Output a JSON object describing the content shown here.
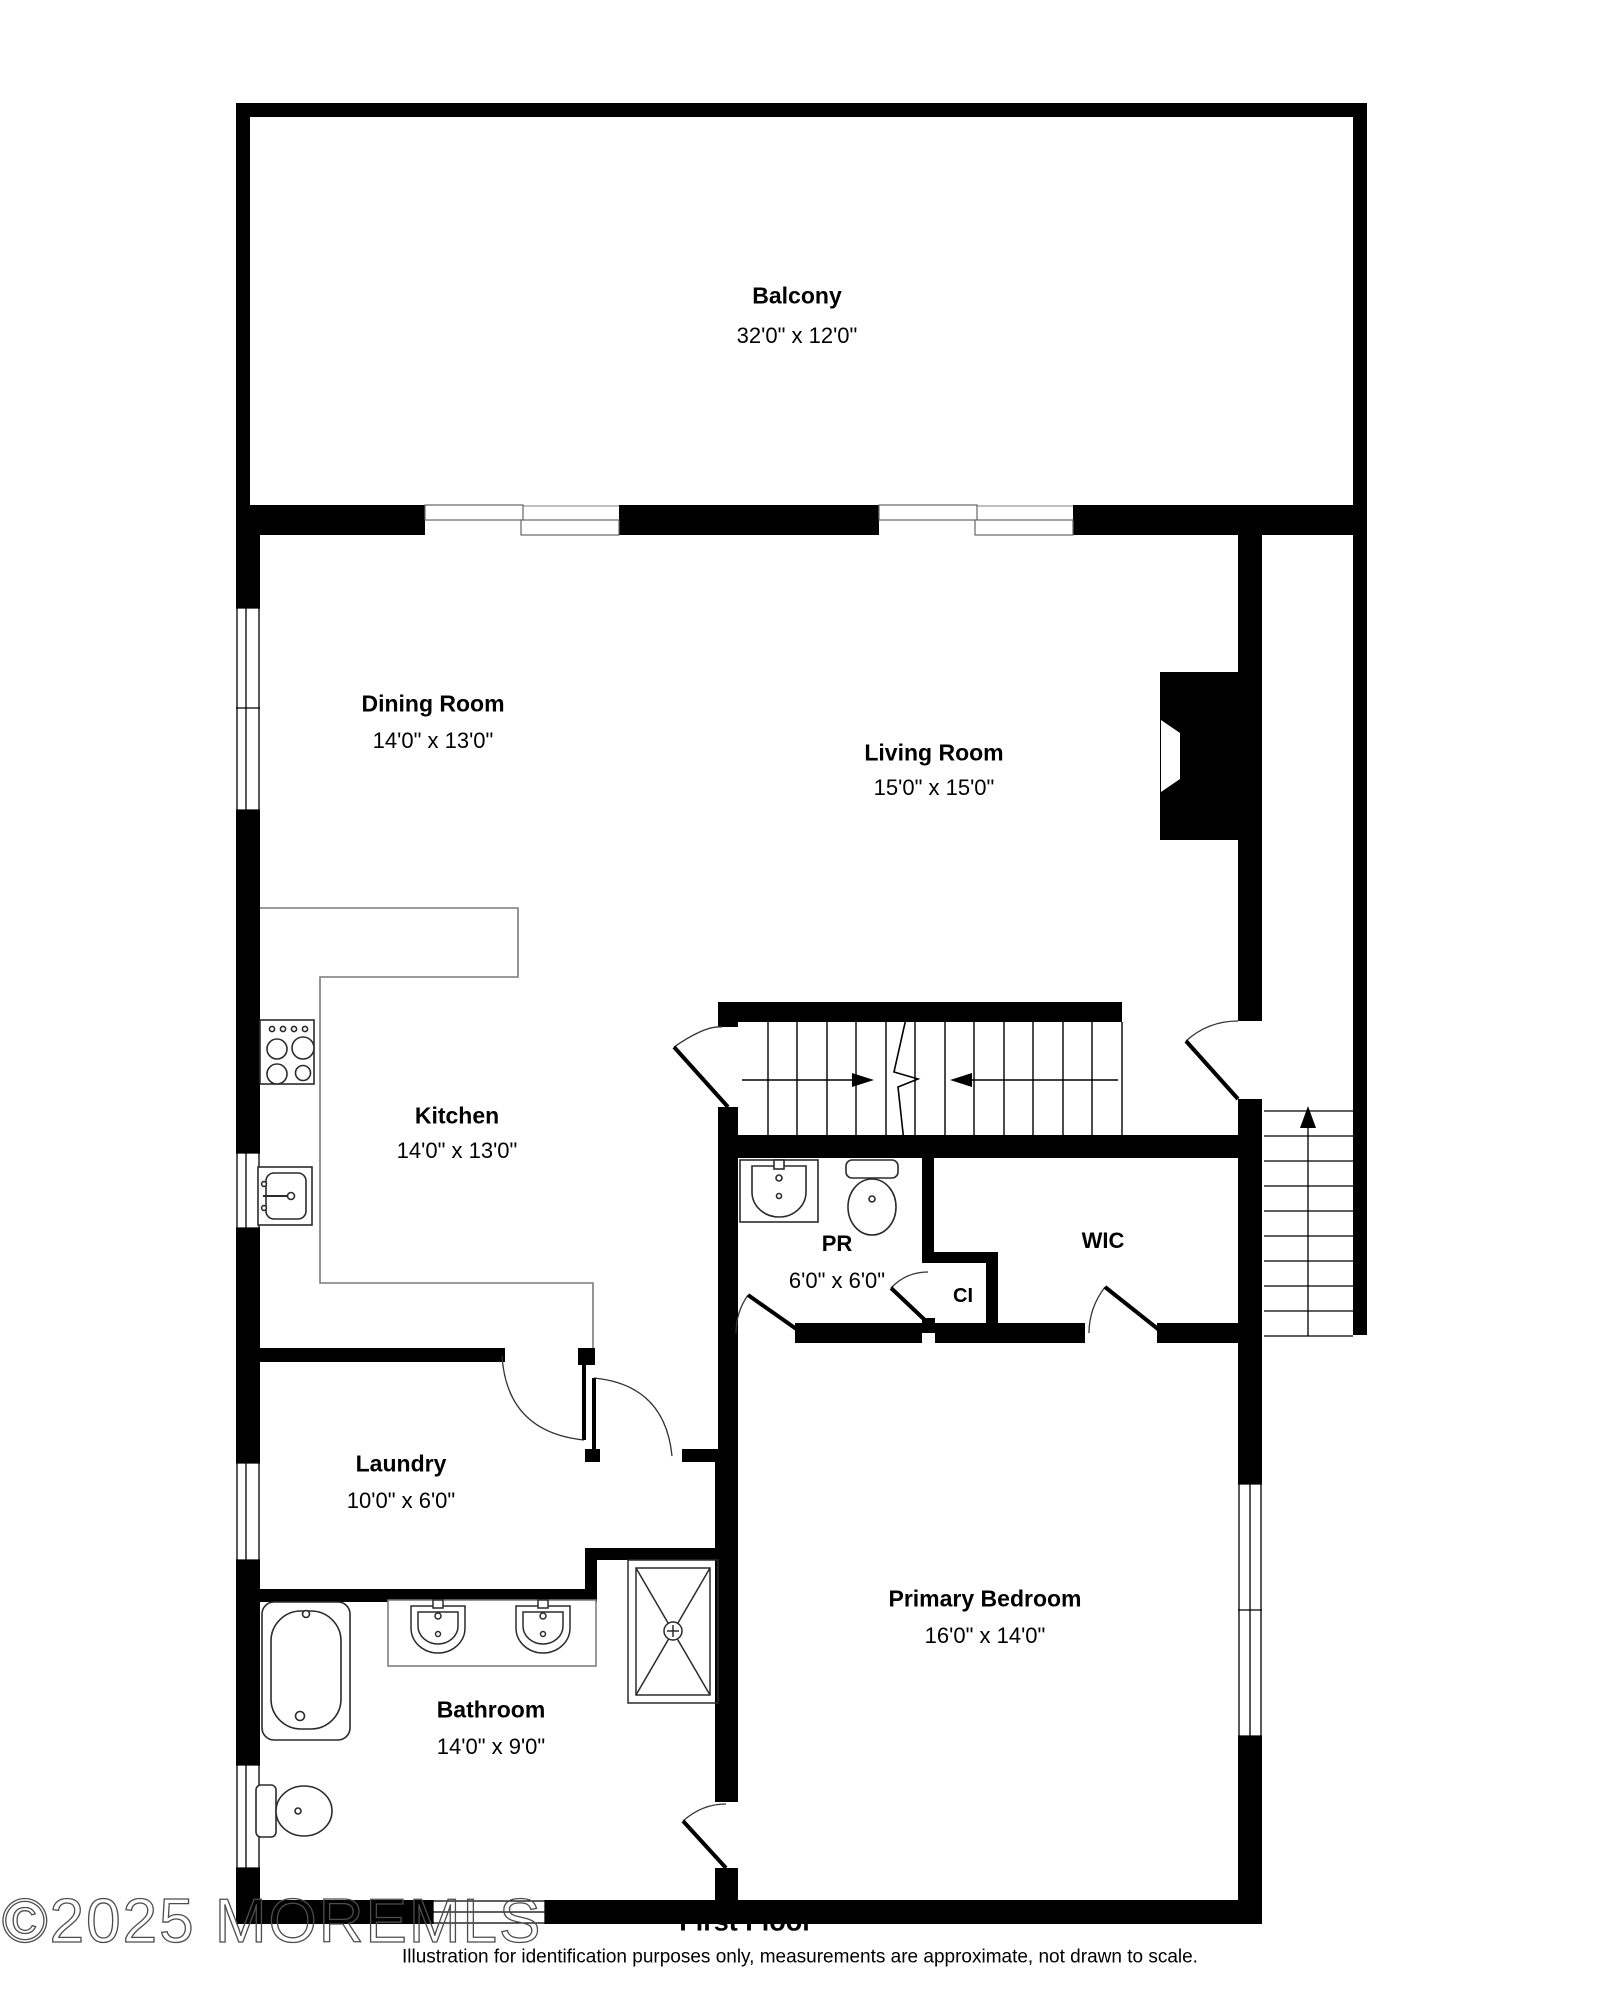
{
  "title": "First floor residential floor plan",
  "colors": {
    "wall": "#000000",
    "background": "#ffffff",
    "fixture_outline": "#2b2b2b",
    "counter_line": "#7a7a7a",
    "door_arc": "#333333",
    "watermark_outline": "#4d4d4d"
  },
  "rooms": {
    "balcony": {
      "name": "Balcony",
      "dims": "32'0\" x 12'0\""
    },
    "dining": {
      "name": "Dining Room",
      "dims": "14'0\" x 13'0\""
    },
    "living": {
      "name": "Living Room",
      "dims": "15'0\" x 15'0\""
    },
    "kitchen": {
      "name": "Kitchen",
      "dims": "14'0\" x 13'0\""
    },
    "pr": {
      "name": "PR",
      "dims": "6'0\" x 6'0\""
    },
    "wic": {
      "name": "WIC",
      "dims": ""
    },
    "ci": {
      "name": "CI",
      "dims": ""
    },
    "laundry": {
      "name": "Laundry",
      "dims": "10'0\" x 6'0\""
    },
    "bathroom": {
      "name": "Bathroom",
      "dims": "14'0\" x 9'0\""
    },
    "primary": {
      "name": "Primary Bedroom",
      "dims": "16'0\" x 14'0\""
    }
  },
  "footer": {
    "floor_label": "First Floor",
    "disclaimer": "Illustration for identification purposes only, measurements are approximate, not drawn to scale.",
    "watermark": "©2025 MOREMLS"
  },
  "icons": [
    "stove-icon",
    "kitchen-sink-icon",
    "pr-sink-icon",
    "pr-toilet-icon",
    "bathtub-icon",
    "vanity-sinks-icon",
    "shower-icon",
    "bath-toilet-icon",
    "fireplace-icon",
    "interior-stairs-icon",
    "exterior-stairs-icon",
    "door-arc-icon",
    "window-icon",
    "sliding-door-icon",
    "up-arrow-icon"
  ]
}
